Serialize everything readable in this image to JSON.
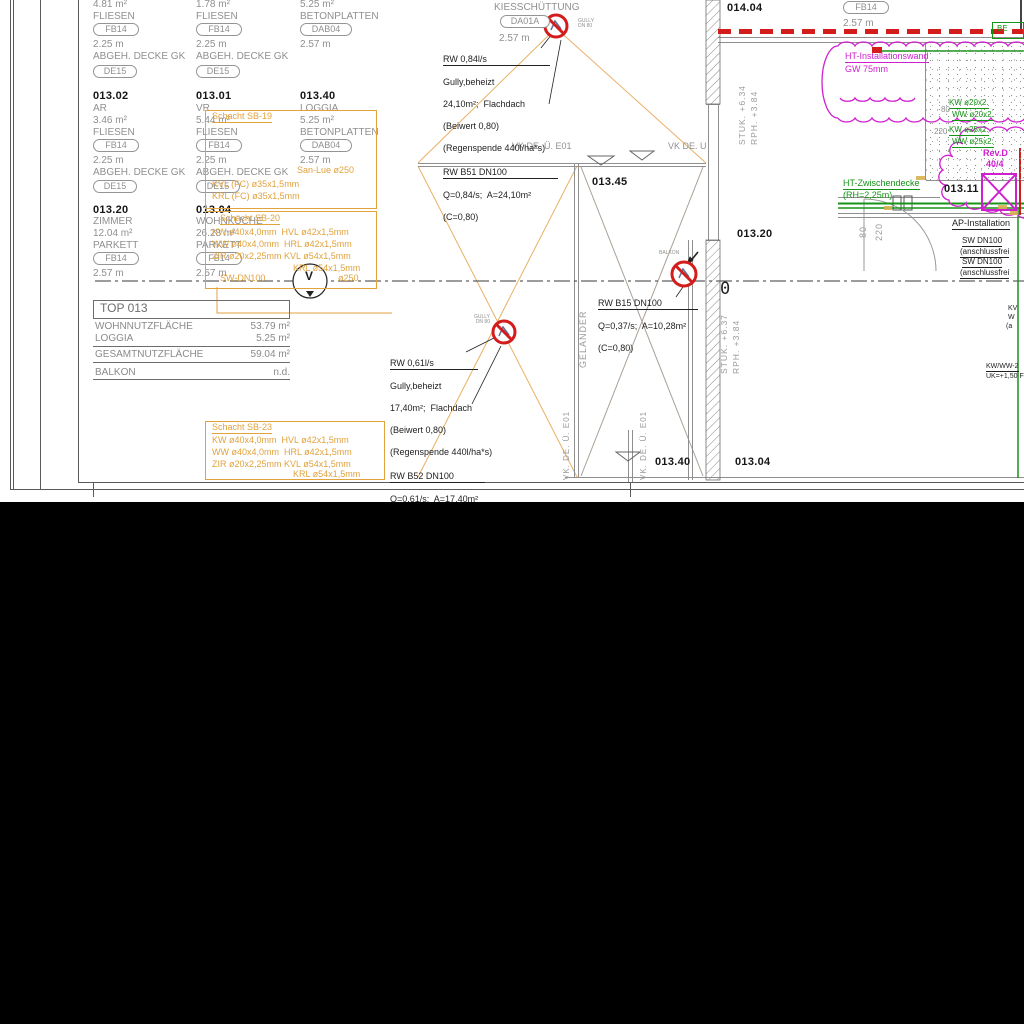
{
  "colors": {
    "orange": "#e2a23c",
    "magenta": "#cf1fcf",
    "green": "#169416",
    "red": "#d31d1d",
    "gray": "#8f8f8f",
    "black": "#1f1f1f"
  },
  "codes": {
    "fb14": "FB14",
    "de15": "DE15",
    "dab04": "DAB04",
    "da01a": "DA01A"
  },
  "schedule": {
    "col1": {
      "partial": {
        "area": "4.81 m²",
        "floor": "FLIESEN",
        "height": "2.25 m",
        "ceiling": "ABGEH. DECKE GK"
      },
      "room1": {
        "number": "013.02",
        "name": "AR",
        "area": "3.46 m²",
        "floor": "FLIESEN",
        "height": "2.25 m",
        "ceiling": "ABGEH. DECKE GK"
      },
      "room2": {
        "number": "013.20",
        "name": "ZIMMER",
        "area": "12.04 m²",
        "floor": "PARKETT",
        "height": "2.57 m"
      }
    },
    "col2": {
      "partial": {
        "area": "1.78 m²",
        "floor": "FLIESEN",
        "height": "2.25 m",
        "ceiling": "ABGEH. DECKE GK"
      },
      "room1": {
        "number": "013.01",
        "name": "VR",
        "area": "5.44 m²",
        "floor": "FLIESEN",
        "height": "2.25 m",
        "ceiling": "ABGEH. DECKE GK"
      },
      "room2": {
        "number": "013.04",
        "name": "WOHNKÜCHE",
        "area": "26.28 m²",
        "floor": "PARKETT",
        "height": "2.57 m"
      }
    },
    "col3": {
      "partial": {
        "area": "5.25 m²",
        "floor": "BETONPLATTEN",
        "height": "2.57 m"
      },
      "room1": {
        "number": "013.40",
        "name": "LOGGIA",
        "area": "5.25 m²",
        "floor": "BETONPLATTEN",
        "height": "2.57 m"
      }
    }
  },
  "top013": {
    "title": "TOP 013",
    "row1_label": "WOHNNUTZFLÄCHE",
    "row1_value": "53.79 m²",
    "row2_label": "LOGGIA",
    "row2_value": "5.25 m²",
    "row3_label": "GESAMTNUTZFLÄCHE",
    "row3_value": "59.04 m²",
    "row4_label": "BALKON",
    "row4_value": "n.d."
  },
  "shafts": {
    "sb19": {
      "title": "Schacht SB-19",
      "line1": "San-Lue ø250",
      "line2": "KVL (FC) ø35x1,5mm",
      "line3": "KRL (FC) ø35x1,5mm"
    },
    "sb20": {
      "title": "Schacht SB-20",
      "line1": "KW ø40x4,0mm  HVL ø42x1,5mm",
      "line2": "WW ø40x4,0mm  HRL ø42x1,5mm",
      "line3": "ZIR ø20x2,25mm KVL ø54x1,5mm",
      "line4": "KRL ø54x1,5mm",
      "line5": "SW-DN100",
      "line6": "ø250"
    },
    "sb23": {
      "title": "Schacht SB-23",
      "line1": "KW ø40x4,0mm  HVL ø42x1,5mm",
      "line2": "WW ø40x4,0mm  HRL ø42x1,5mm",
      "line3": "ZIR ø20x2,25mm KVL ø54x1,5mm",
      "line4": "KRL ø54x1,5mm"
    }
  },
  "roof": {
    "kies": "KIESSCHÜTTUNG",
    "kies_height": "2.57 m",
    "vk1": "VK DE. Ü. E01",
    "vk2": "VK DE. Ü"
  },
  "notes": {
    "rw1": {
      "head": "RW 0,84l/s",
      "l2": "Gully,beheizt",
      "l3": "24,10m²;  Flachdach",
      "l4": "(Beiwert 0,80)",
      "l5": "(Regenspende 440l/ha*s)",
      "head2": "RW B51 DN100",
      "l7": "Q=0,84/s;  A=24,10m²",
      "l8": "(C=0,80)"
    },
    "rw2": {
      "head": "RW 0,61l/s",
      "l2": "Gully,beheizt",
      "l3": "17,40m²;  Flachdach",
      "l4": "(Beiwert 0,80)",
      "l5": "(Regenspende 440l/ha*s)",
      "head2": "RW B52 DN100",
      "l7": "Q=0,61/s;  A=17,40m²",
      "l8": "(C=0,80)"
    },
    "b15": {
      "head": "RW B15 DN100",
      "l2": "Q=0,37/s;  A=10,28m²",
      "l3": "(C=0,80)"
    }
  },
  "symbols": {
    "gully_l1": "GULLY",
    "gully_l2": "DN 80",
    "balkon": "BALKON",
    "valve": "V",
    "zero": "0"
  },
  "plan_rooms": {
    "r01345": "013.45",
    "r01320": "013.20",
    "r01404": "014.04",
    "r01311": "013.11",
    "r01340": "013.40",
    "r01304": "013.04"
  },
  "right": {
    "h257": "2.57 m",
    "be": "BE",
    "ht_wand": "HT-Installationswand",
    "gw": "GW 75mm",
    "ht_decke": "HT-Zwischendecke",
    "rh": "(RH=2,25m)",
    "revd": "Rev.D",
    "rev_num": "40/4",
    "ap": "AP-Installation",
    "sw1": "SW DN100",
    "sw1b": "(anschlussfrei",
    "sw2": "SW DN100",
    "sw2b": "(anschlussfrei",
    "kw20": "KW ø20x2.",
    "ww20": "WW ø20x2.",
    "kw25": "KW ø25x2.",
    "ww25": "WW ø25x2.",
    "d80": "80",
    "d220": "220",
    "d80v": "80",
    "d220v": "220",
    "kwww": "KW/WW-2",
    "uk": "UK=+1,50 F",
    "frag1": "KV",
    "frag2": "W",
    "frag3": "(a"
  },
  "levels": {
    "stuk1": "STUK. +6.34",
    "rph1": "RPH. +3.84",
    "stuk2": "STUK. +6.37",
    "rph2": "RPH. +3.84",
    "gelaender": "GELÄNDER",
    "vkde_left": "VK. DE. Ü. E01",
    "vkde_right": "VK. DE. Ü. E01"
  }
}
